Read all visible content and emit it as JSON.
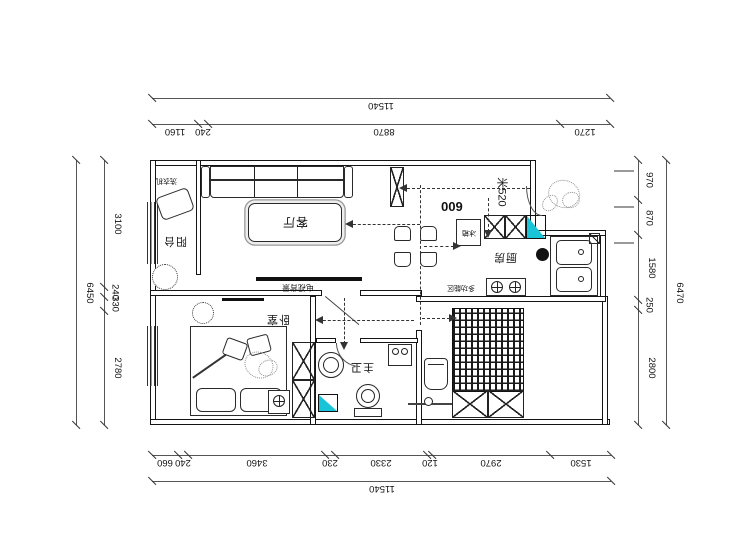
{
  "colors": {
    "line": "#141414",
    "dim": "#555555",
    "accent_cyan": "#19c3d8",
    "sketch_gray": "#8a8a8a"
  },
  "dimensions": {
    "top_total": {
      "labels": [
        "11540"
      ],
      "values": [
        11540
      ]
    },
    "top": {
      "labels": [
        "1160",
        "240",
        "8870",
        "1270"
      ],
      "values": [
        1160,
        240,
        8870,
        1270
      ]
    },
    "bottom": {
      "labels": [
        "660",
        "240",
        "3460",
        "230",
        "2330",
        "120",
        "2970",
        "1530"
      ],
      "values": [
        660,
        240,
        3460,
        230,
        2330,
        120,
        2970,
        1530
      ]
    },
    "bottom_total": {
      "labels": [
        "11540"
      ],
      "values": [
        11540
      ]
    },
    "left": {
      "labels": [
        "3100",
        "240",
        "330",
        "2780"
      ],
      "values": [
        3100,
        240,
        330,
        2780
      ]
    },
    "left_total": {
      "labels": [
        "6450"
      ],
      "values": [
        6450
      ]
    },
    "right": {
      "labels": [
        "970",
        "870",
        "1580",
        "250",
        "2800"
      ],
      "values": [
        970,
        870,
        1580,
        250,
        2800
      ]
    },
    "right_total": {
      "labels": [
        "6470"
      ],
      "values": [
        6470
      ]
    }
  },
  "rooms": {
    "balcony": "阳台",
    "living_room": "客厅",
    "bedroom": "卧室",
    "master_bath": "主卫",
    "kitchen": "厨房",
    "multi_function": "多功能区"
  },
  "annotations": {
    "washing_machine": "洗衣机",
    "tv_wall": "电视背景",
    "fridge": "冰箱",
    "opening_600": "600",
    "note_520": "米520"
  }
}
